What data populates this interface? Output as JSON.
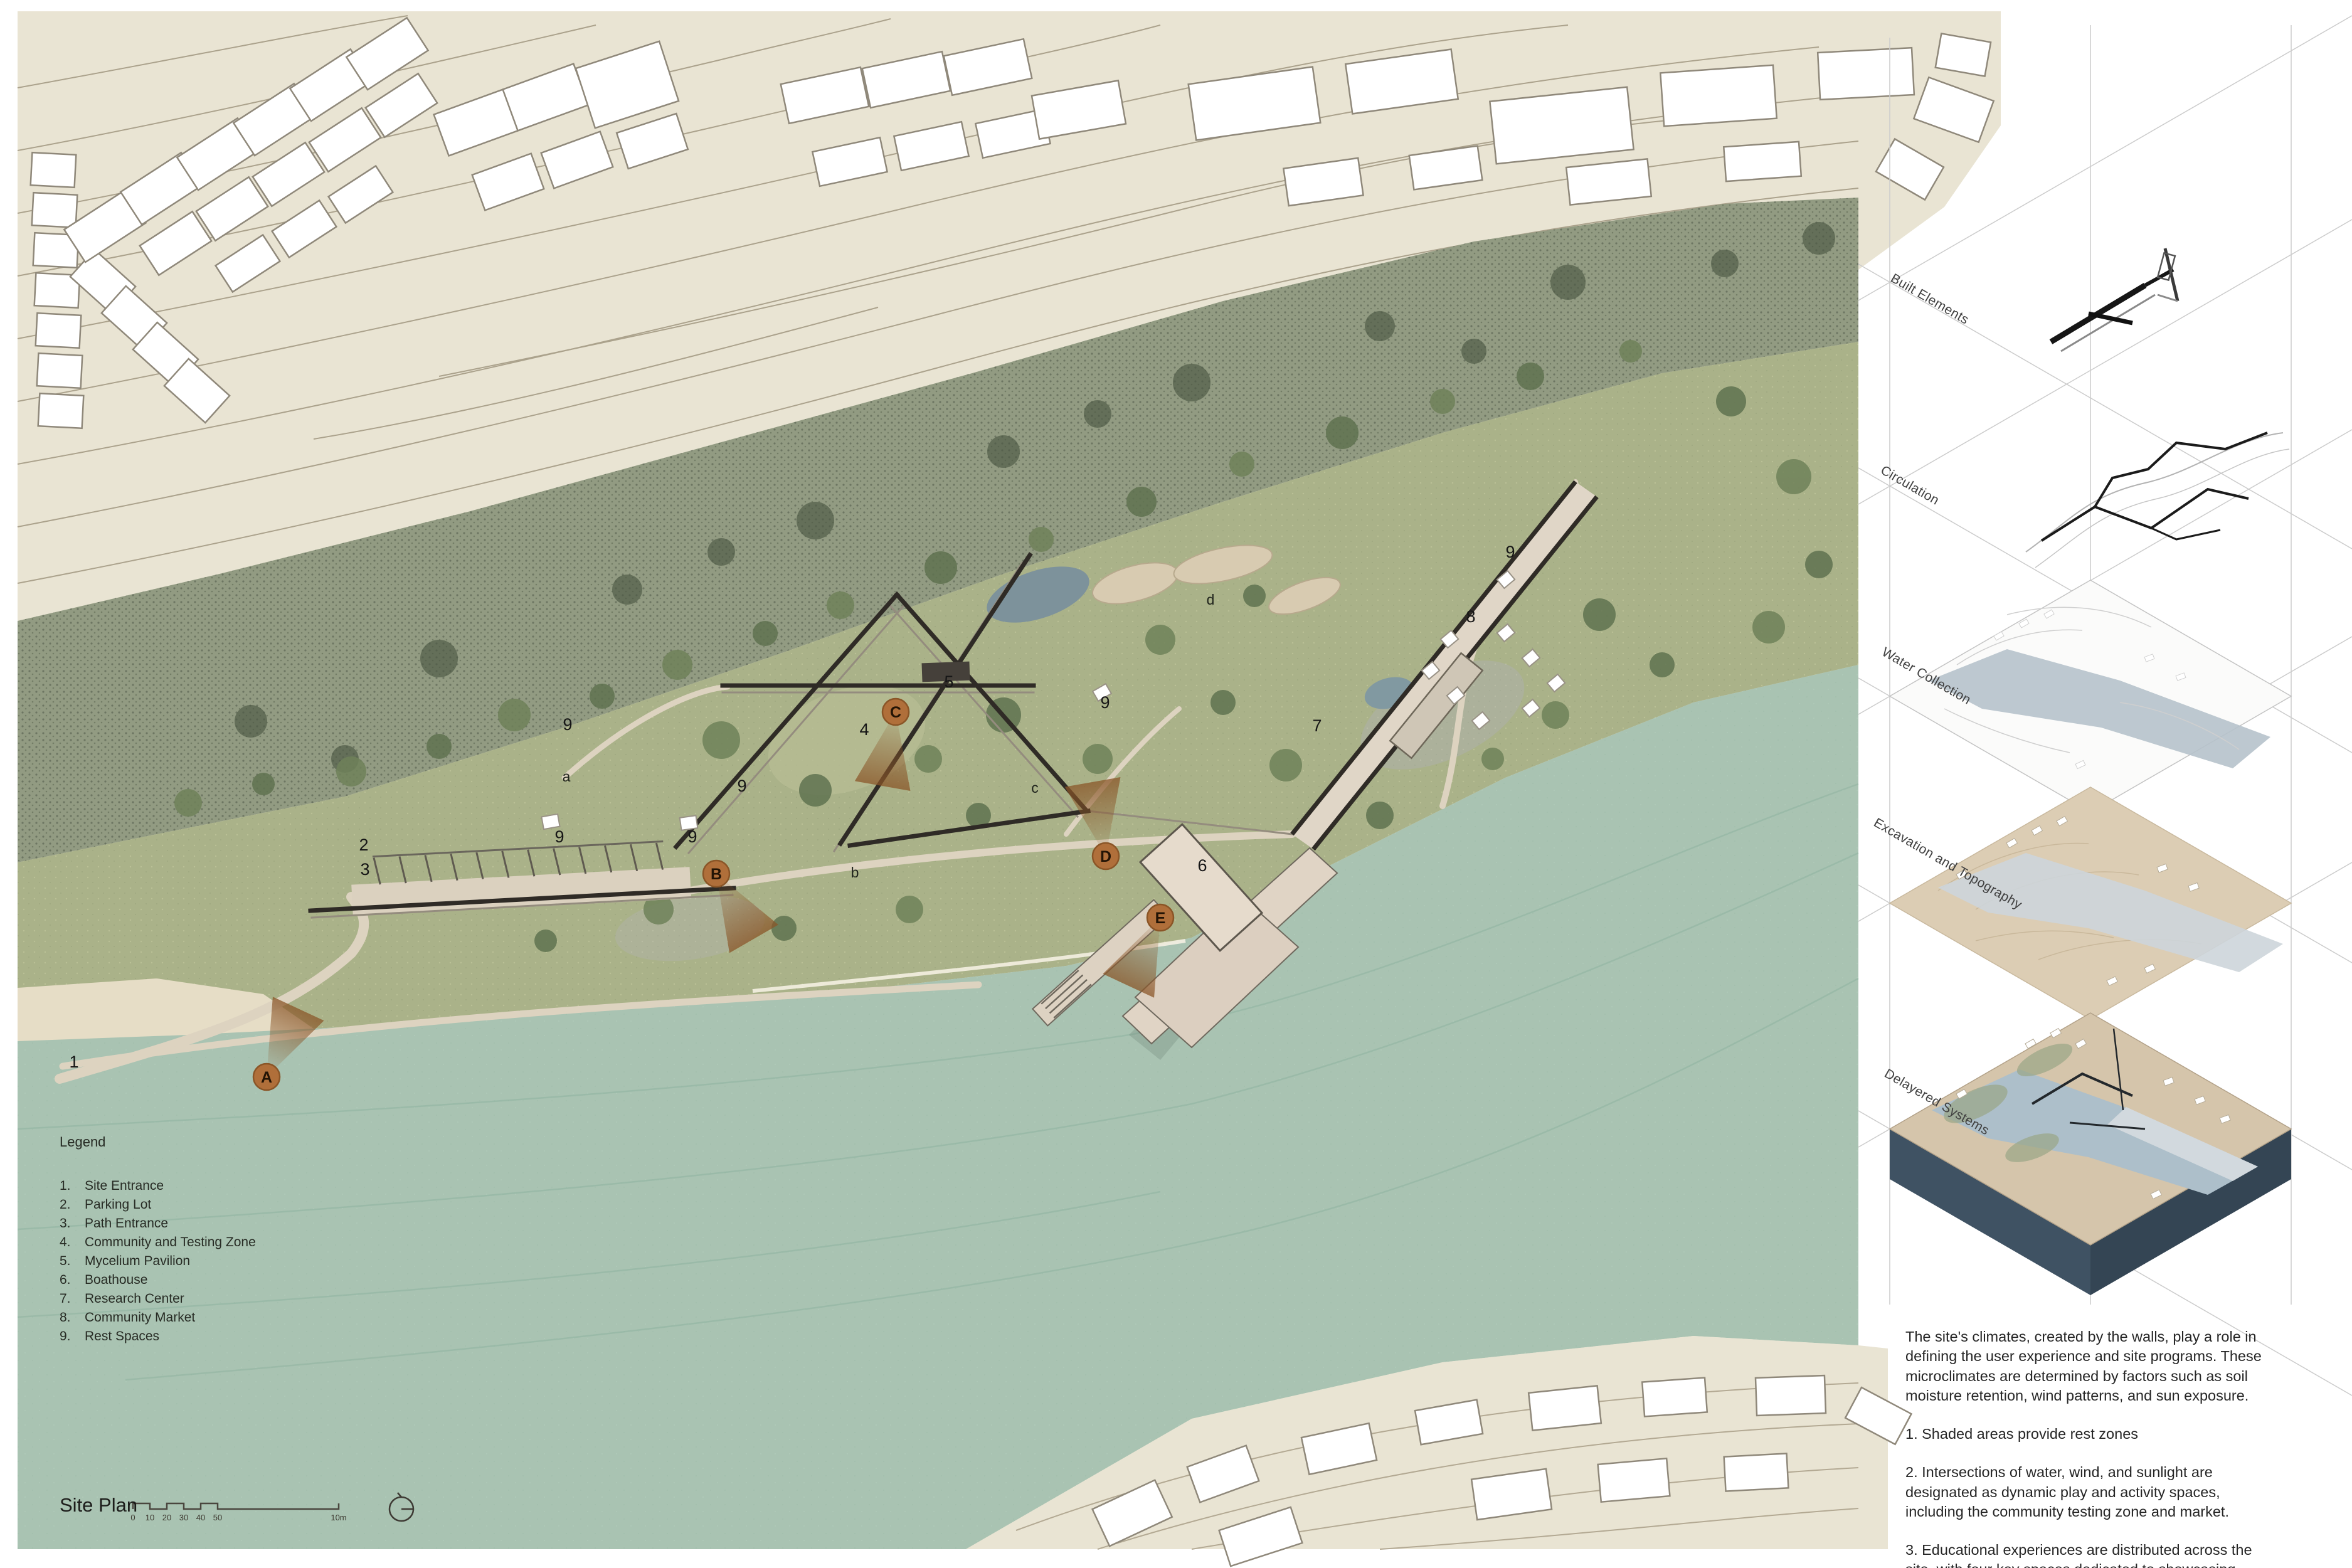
{
  "plan": {
    "label": "Site Plan",
    "legend": {
      "title": "Legend",
      "items": [
        {
          "num": "1.",
          "label": "Site Entrance"
        },
        {
          "num": "2.",
          "label": "Parking Lot"
        },
        {
          "num": "3.",
          "label": "Path Entrance"
        },
        {
          "num": "4.",
          "label": "Community and Testing Zone"
        },
        {
          "num": "5.",
          "label": "Mycelium Pavilion"
        },
        {
          "num": "6.",
          "label": "Boathouse"
        },
        {
          "num": "7.",
          "label": "Research Center"
        },
        {
          "num": "8.",
          "label": "Community Market"
        },
        {
          "num": "9.",
          "label": "Rest Spaces"
        }
      ]
    },
    "scale": {
      "ticks": [
        "0",
        "10",
        "20",
        "30",
        "40",
        "50"
      ],
      "end": "10m"
    },
    "markers": [
      {
        "label": "1"
      },
      {
        "label": "2"
      },
      {
        "label": "3"
      },
      {
        "label": "9"
      },
      {
        "label": "9"
      },
      {
        "label": "9"
      },
      {
        "label": "a"
      },
      {
        "label": "9"
      },
      {
        "label": "4"
      },
      {
        "label": "5"
      },
      {
        "label": "9"
      },
      {
        "label": "c"
      },
      {
        "label": "b"
      },
      {
        "label": "6"
      },
      {
        "label": "7"
      },
      {
        "label": "8"
      },
      {
        "label": "9"
      },
      {
        "label": "d"
      }
    ],
    "zone_markers": [
      {
        "label": "A"
      },
      {
        "label": "B"
      },
      {
        "label": "C"
      },
      {
        "label": "D"
      },
      {
        "label": "E"
      }
    ]
  },
  "panel": {
    "diagrams": [
      {
        "label": "Built Elements"
      },
      {
        "label": "Circulation"
      },
      {
        "label": "Water Collection"
      },
      {
        "label": "Excavation and Topography"
      },
      {
        "label": "Delayered Systems"
      }
    ],
    "notes": {
      "intro": "The site's climates, created by the walls, play a role in defining the user experience and site programs. These microclimates are determined by factors such as soil moisture retention, wind patterns, and sun exposure.",
      "item1": "1. Shaded areas provide rest zones",
      "item2": "2. Intersections of water, wind, and sunlight are designated as dynamic play and activity spaces, including the community testing zone and market.",
      "item3": "3. Educational experiences are distributed across the site, with four key spaces dedicated to showcasing Cambridge's historical sites."
    }
  },
  "colors": {
    "paper_terrain": "#e9e4d3",
    "vegetated_slope": "#929b82",
    "park_green": "#aab289",
    "river": "#a9c3b2",
    "path_tan": "#ddd3c0",
    "wall_dark": "#2f2b26",
    "zone_marker_brown": "#b06f3a",
    "slab_navy": "#3f5263",
    "diagram_river_blue": "#b6c2cb"
  }
}
